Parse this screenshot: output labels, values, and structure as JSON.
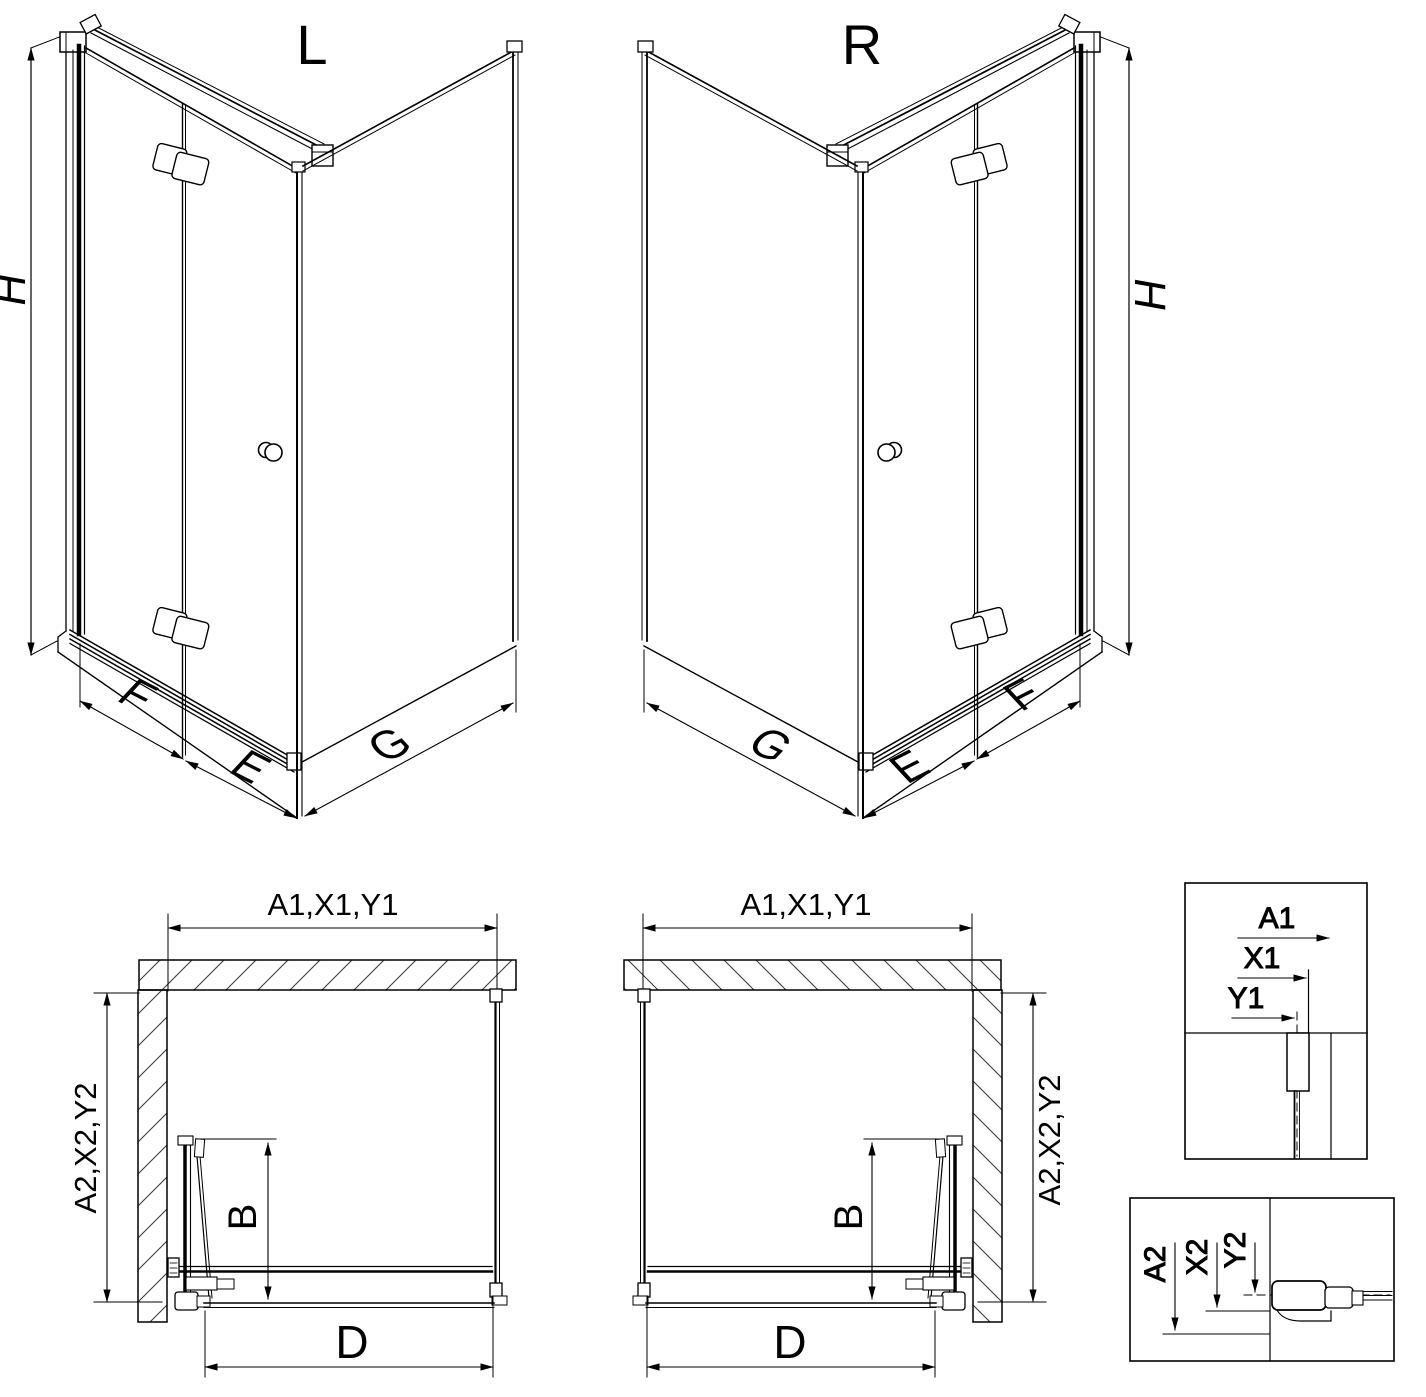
{
  "views": {
    "left": {
      "label": "L"
    },
    "right": {
      "label": "R"
    }
  },
  "dims": {
    "height": "H",
    "door_leaf": "F",
    "fixed_section": "E",
    "side_panel": "G",
    "fold_depth": "B",
    "entry_width": "D",
    "top_combo": "A1,X1,Y1",
    "side_combo": "A2,X2,Y2"
  },
  "details": {
    "upper": {
      "to_wall": "A1",
      "to_profile": "X1",
      "to_glass": "Y1"
    },
    "lower": {
      "to_wall": "A2",
      "to_profile": "X2",
      "to_glass": "Y2"
    }
  },
  "colors": {
    "line": "#000000",
    "hatch": "#3c3c3c",
    "background": "#ffffff"
  }
}
